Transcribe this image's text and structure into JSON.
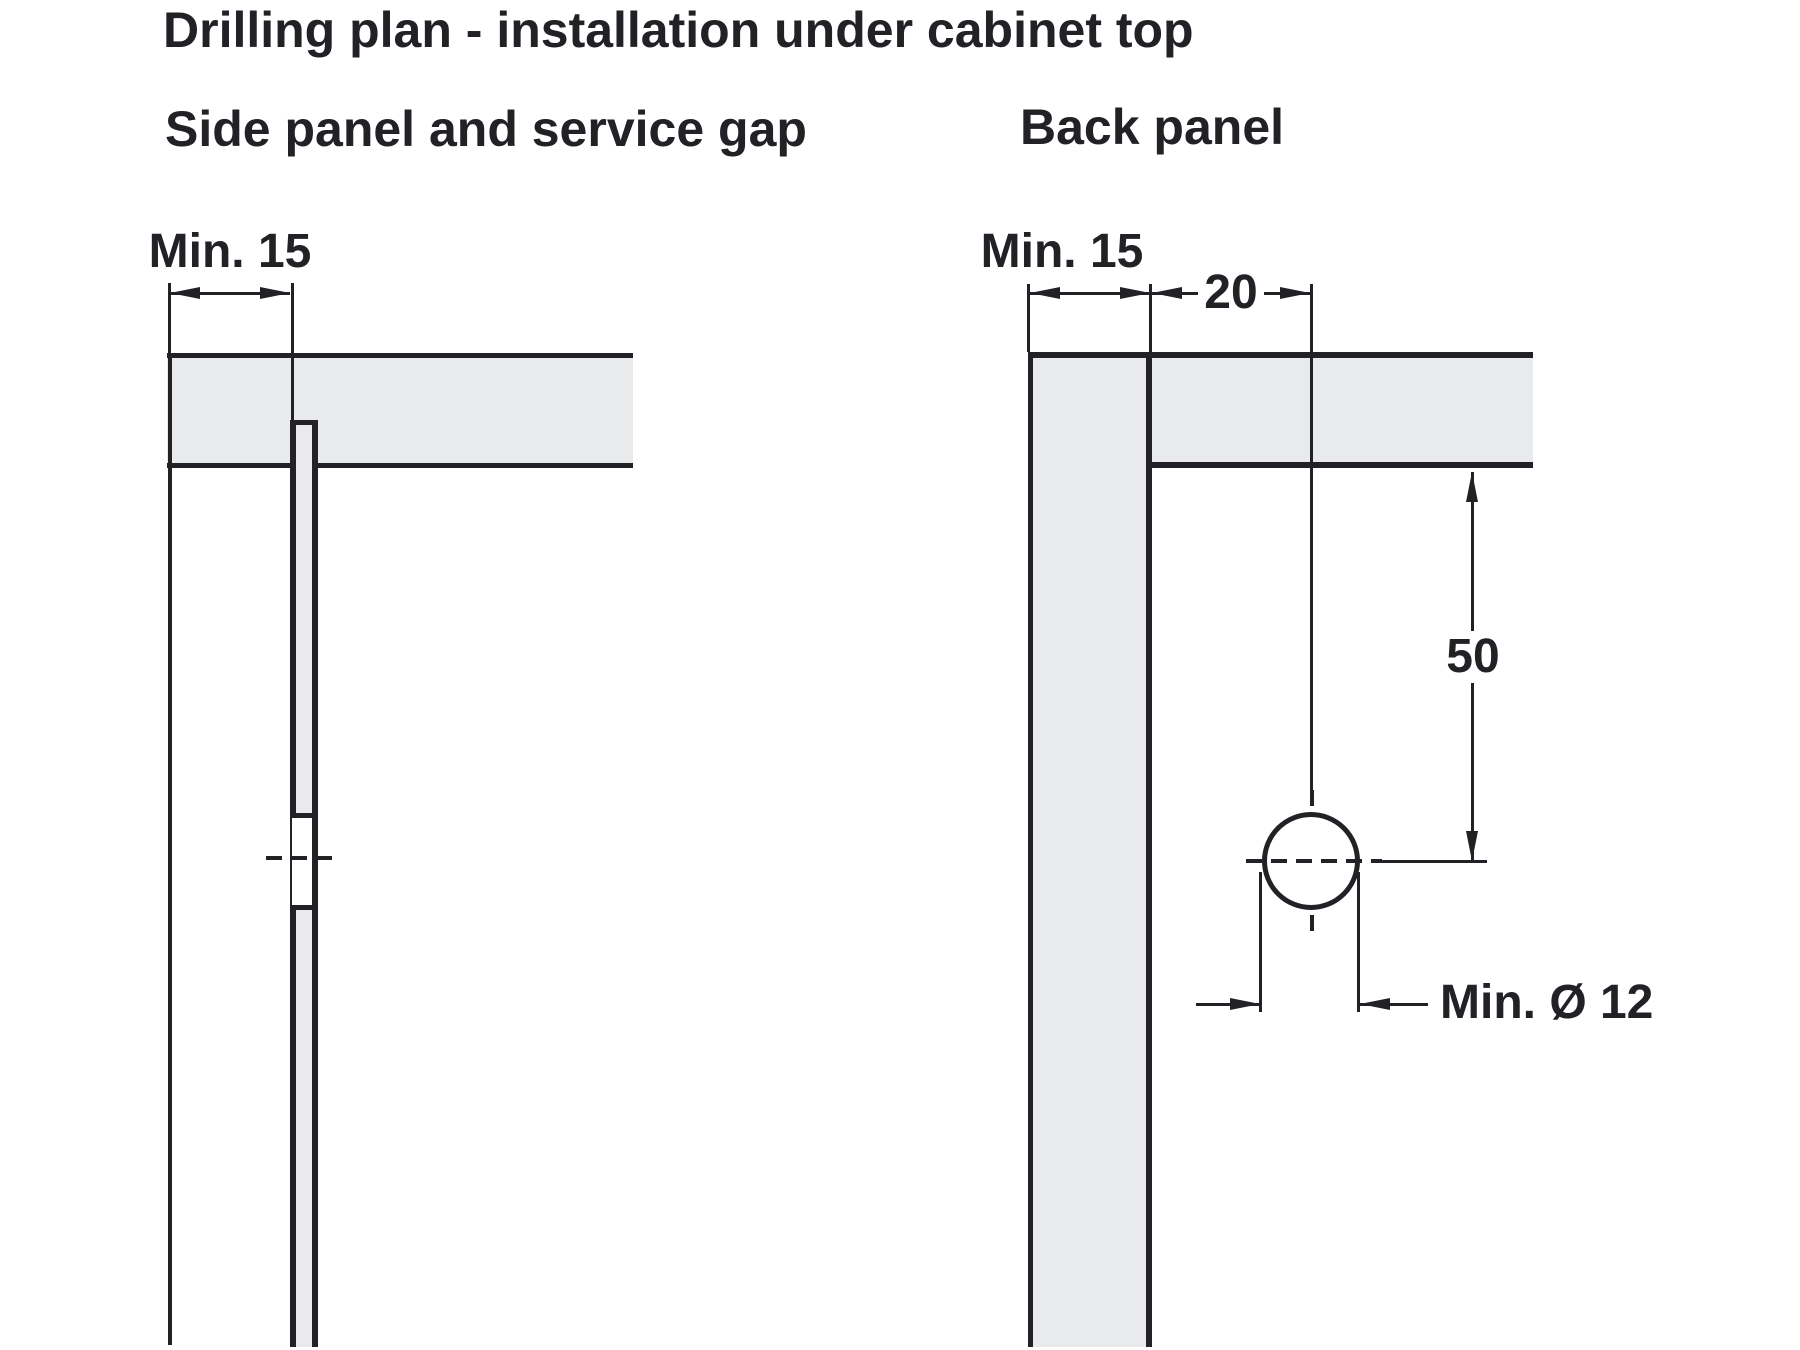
{
  "title": "Drilling plan - installation under cabinet top",
  "sections": {
    "left": {
      "heading": "Side panel and service gap",
      "dims": {
        "side_gap": "Min. 15"
      }
    },
    "right": {
      "heading": "Back panel",
      "dims": {
        "side_gap": "Min. 15",
        "offset": "20",
        "depth": "50",
        "hole_diameter": "Min. Ø 12"
      }
    }
  },
  "colors": {
    "line": "#212126",
    "panel_fill": "#e9eaeb",
    "background": "#ffffff"
  }
}
